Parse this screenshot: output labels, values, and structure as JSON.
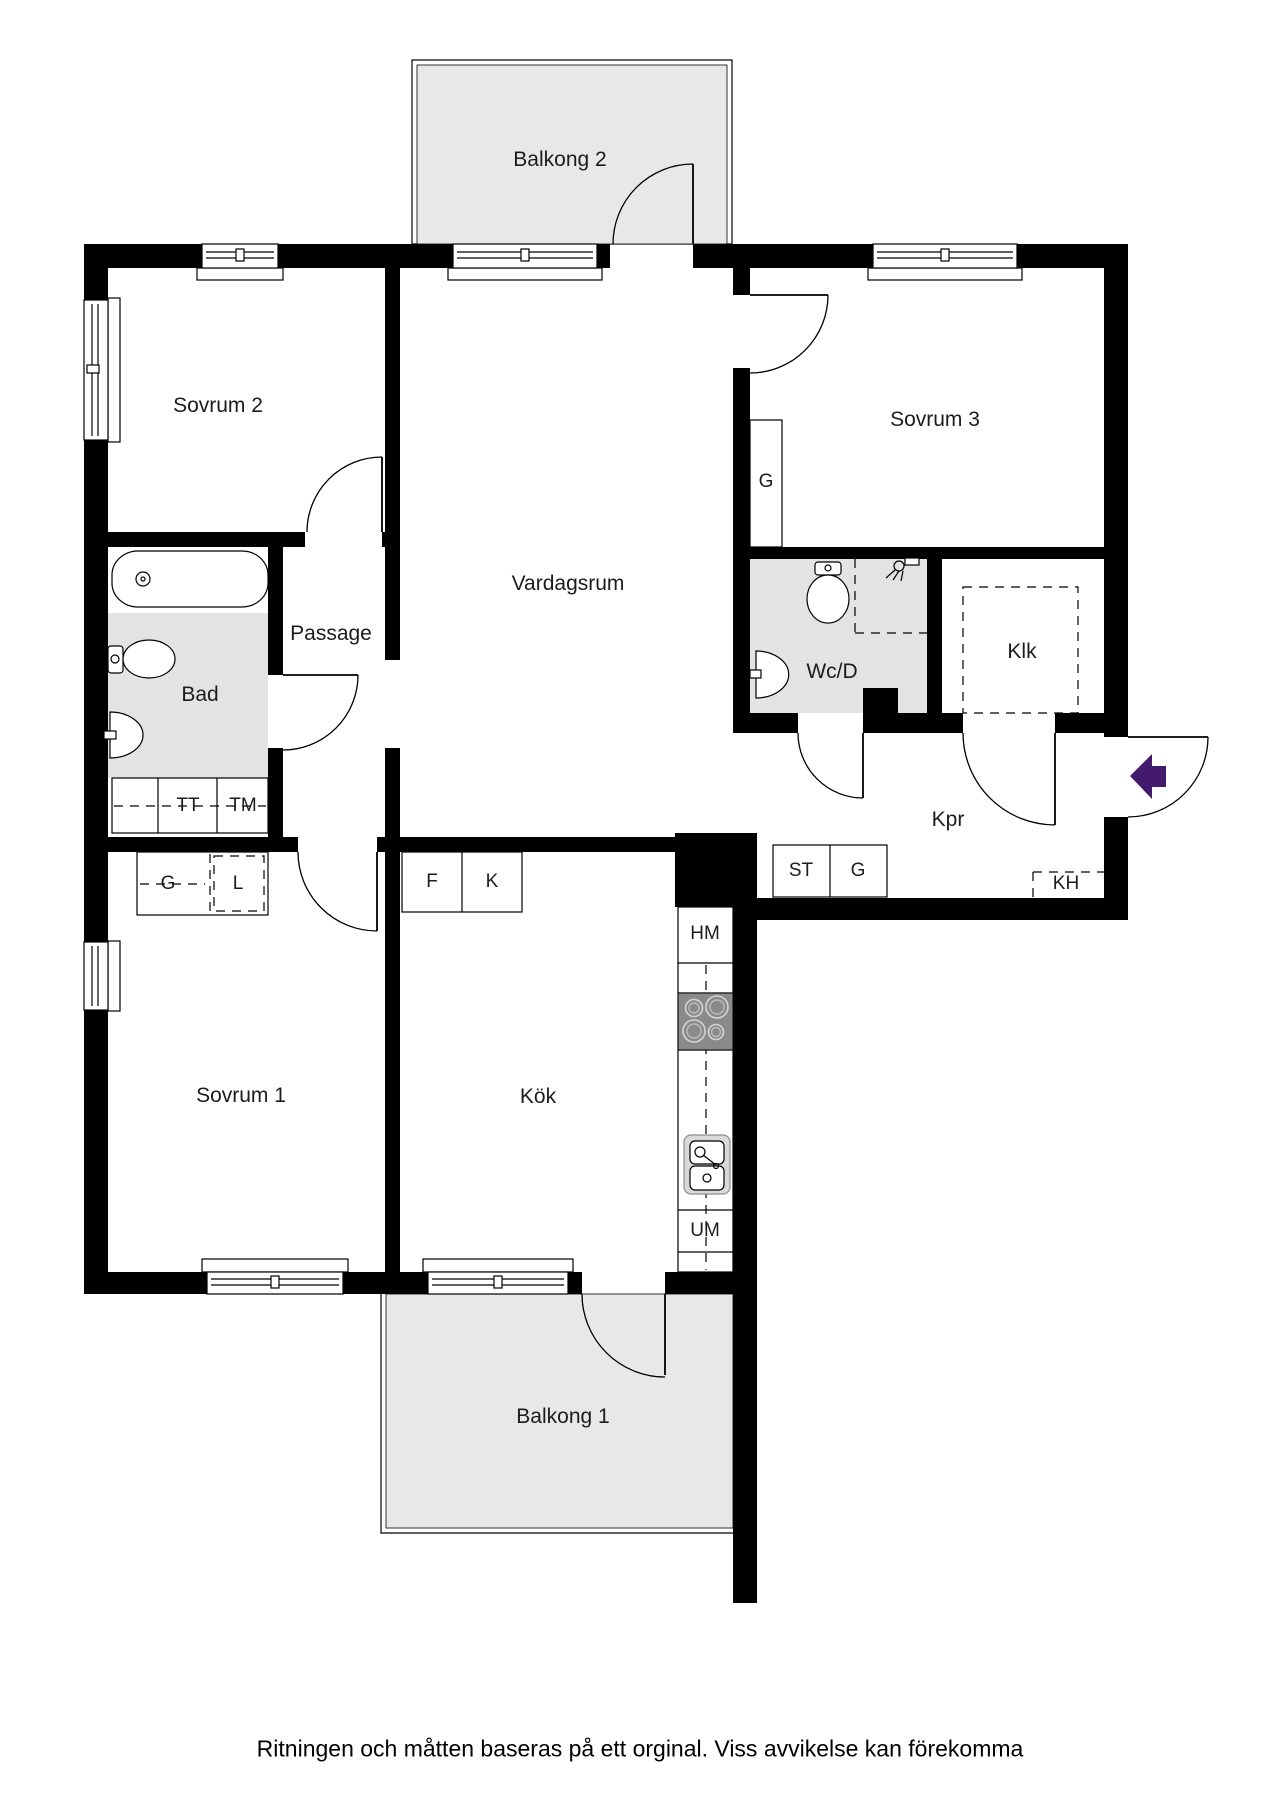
{
  "rooms": {
    "balkong2": "Balkong 2",
    "sovrum2": "Sovrum 2",
    "sovrum3": "Sovrum 3",
    "vardagsrum": "Vardagsrum",
    "passage": "Passage",
    "bad": "Bad",
    "wcd": "Wc/D",
    "klk": "Klk",
    "kpr": "Kpr",
    "sovrum1": "Sovrum 1",
    "kok": "Kök",
    "balkong1": "Balkong 1"
  },
  "cabinets": {
    "g_sovrum3": "G",
    "tt": "TT",
    "tm": "TM",
    "g_sovrum1": "G",
    "l_sovrum1": "L",
    "f_kok": "F",
    "k_kok": "K",
    "st_kpr": "ST",
    "g_kpr": "G",
    "kh_kpr": "KH",
    "hm_kok": "HM",
    "um_kok": "UM"
  },
  "colors": {
    "wall": "#000000",
    "balcony_floor": "#e8e8e8",
    "wet_room_floor": "#e3e3e3",
    "stove": "#8a8a8a",
    "entrance_arrow": "#431a6d"
  },
  "footer_note": "Ritningen och måtten baseras på ett orginal. Viss avvikelse kan förekomma"
}
